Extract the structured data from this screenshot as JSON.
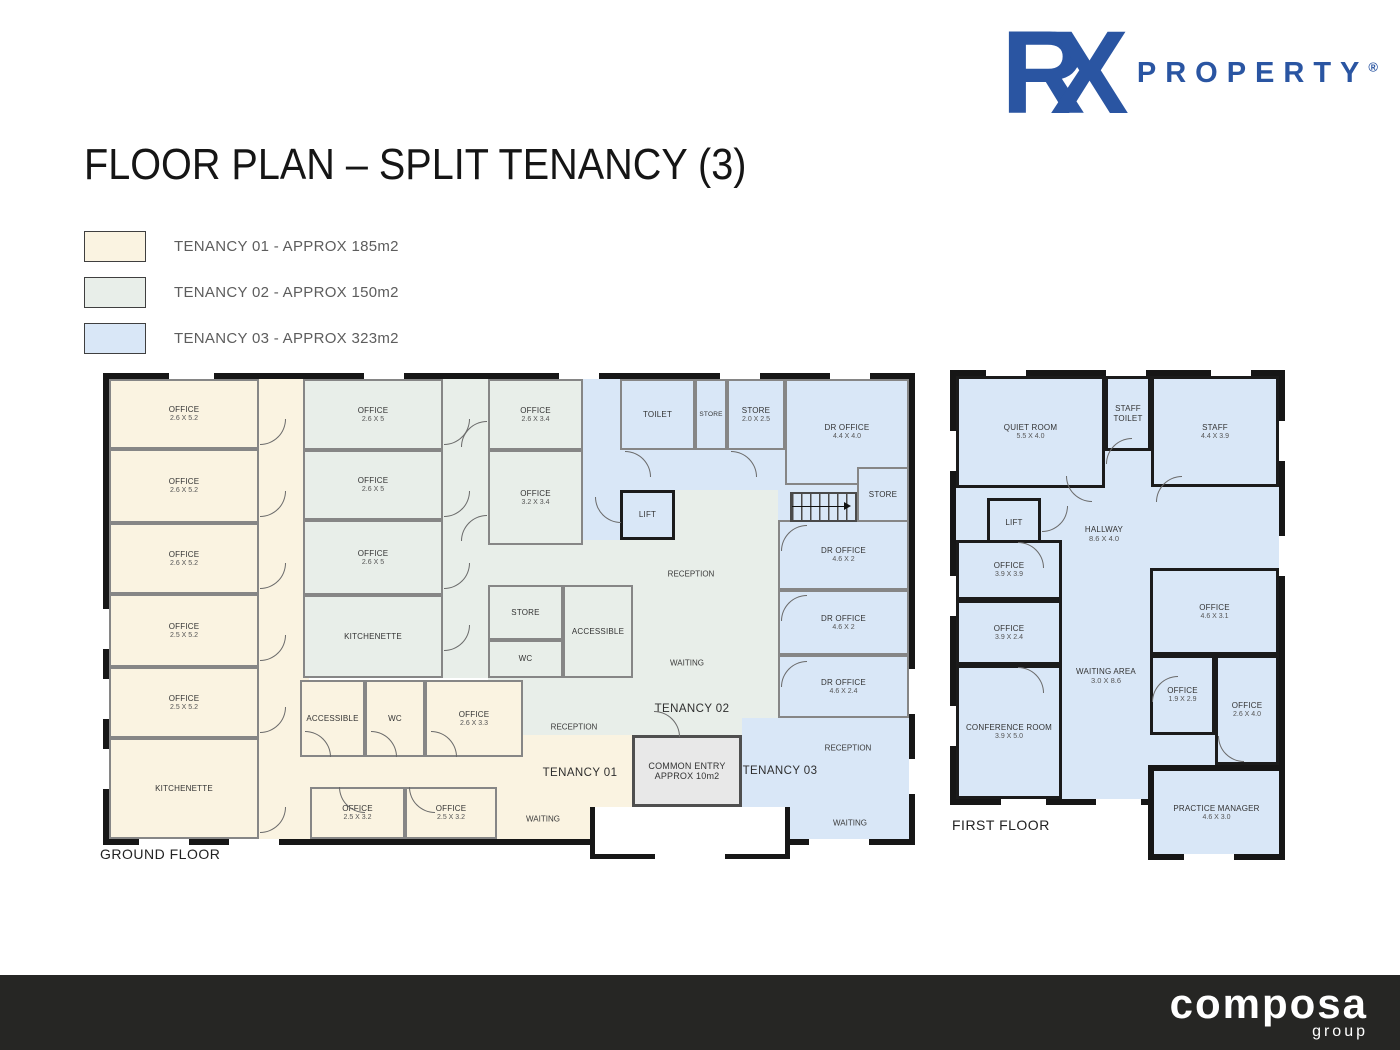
{
  "logo": {
    "r": "R",
    "x": "X",
    "brand": "PROPERTY",
    "reg": "®"
  },
  "title": "FLOOR PLAN – SPLIT TENANCY (3)",
  "legend": {
    "items": [
      {
        "label": "TENANCY 01 - APPROX 185m2",
        "color": "#FAF3E1"
      },
      {
        "label": "TENANCY 02 - APPROX 150m2",
        "color": "#E8EEE9"
      },
      {
        "label": "TENANCY 03 - APPROX 323m2",
        "color": "#D9E7F7"
      }
    ]
  },
  "ground_floor": {
    "floor_label": "GROUND FLOOR",
    "rooms": [
      {
        "name": "OFFICE",
        "dims": "2.6 X 5.2"
      },
      {
        "name": "OFFICE",
        "dims": "2.6 X 5.2"
      },
      {
        "name": "OFFICE",
        "dims": "2.6 X 5.2"
      },
      {
        "name": "OFFICE",
        "dims": "2.5 X 5.2"
      },
      {
        "name": "OFFICE",
        "dims": "2.5 X 5.2"
      },
      {
        "name": "KITCHENETTE",
        "dims": ""
      },
      {
        "name": "ACCESSIBLE",
        "dims": ""
      },
      {
        "name": "WC",
        "dims": ""
      },
      {
        "name": "OFFICE",
        "dims": "2.6 X 3.3"
      },
      {
        "name": "OFFICE",
        "dims": "2.5 X 3.2"
      },
      {
        "name": "OFFICE",
        "dims": "2.5 X 3.2"
      },
      {
        "name": "OFFICE",
        "dims": "2.6 X 5"
      },
      {
        "name": "OFFICE",
        "dims": "2.6 X 5"
      },
      {
        "name": "OFFICE",
        "dims": "2.6 X 5"
      },
      {
        "name": "KITCHENETTE",
        "dims": ""
      },
      {
        "name": "OFFICE",
        "dims": "2.6 X 3.4"
      },
      {
        "name": "OFFICE",
        "dims": "3.2 X 3.4"
      },
      {
        "name": "STORE",
        "dims": ""
      },
      {
        "name": "WC",
        "dims": ""
      },
      {
        "name": "ACCESSIBLE",
        "dims": ""
      },
      {
        "name": "TOILET",
        "dims": ""
      },
      {
        "name": "STORE",
        "dims": ""
      },
      {
        "name": "STORE",
        "dims": "2.0 X 2.5"
      },
      {
        "name": "DR OFFICE",
        "dims": "4.4 X 4.0"
      },
      {
        "name": "LIFT",
        "dims": ""
      },
      {
        "name": "STORE",
        "dims": ""
      },
      {
        "name": "DR OFFICE",
        "dims": "4.6 X 2"
      },
      {
        "name": "DR OFFICE",
        "dims": "4.6 X 2"
      },
      {
        "name": "DR OFFICE",
        "dims": "4.6 X 2.4"
      }
    ],
    "zones": {
      "t1_reception": "RECEPTION",
      "t1_waiting": "WAITING",
      "t1_name": "TENANCY 01",
      "t2_reception": "RECEPTION",
      "t2_waiting": "WAITING",
      "t2_name": "TENANCY 02",
      "t3_reception": "RECEPTION",
      "t3_waiting": "WAITING",
      "t3_name": "TENANCY 03",
      "common_entry": {
        "line1": "COMMON ENTRY",
        "line2": "APPROX 10m2"
      }
    }
  },
  "first_floor": {
    "floor_label": "FIRST FLOOR",
    "rooms": [
      {
        "name": "QUIET ROOM",
        "dims": "5.5 X 4.0"
      },
      {
        "name": "STAFF TOILET",
        "dims": ""
      },
      {
        "name": "STAFF",
        "dims": "4.4 X 3.9"
      },
      {
        "name": "LIFT",
        "dims": ""
      },
      {
        "name": "OFFICE",
        "dims": "3.9 X 3.9"
      },
      {
        "name": "OFFICE",
        "dims": "3.9 X 2.4"
      },
      {
        "name": "CONFERENCE ROOM",
        "dims": "3.9 X 5.0"
      },
      {
        "name": "OFFICE",
        "dims": "4.6 X 3.1"
      },
      {
        "name": "OFFICE",
        "dims": "1.9 X 2.9"
      },
      {
        "name": "OFFICE",
        "dims": "2.6 X 4.0"
      }
    ],
    "zones": {
      "hallway": {
        "name": "HALLWAY",
        "dims": "8.6 X 4.0"
      },
      "waiting_area": {
        "name": "WAITING AREA",
        "dims": "3.0 X 8.6"
      },
      "practice_manager": {
        "name": "PRACTICE MANAGER",
        "dims": "4.6 X 3.0"
      }
    }
  },
  "footer": {
    "brand": "composa",
    "sub": "group"
  },
  "colors": {
    "tenancy1": "#FAF3E1",
    "tenancy2": "#E8EEE9",
    "tenancy3": "#D9E7F7",
    "accent_blue": "#2a55a2",
    "footer_bg": "#262624"
  }
}
